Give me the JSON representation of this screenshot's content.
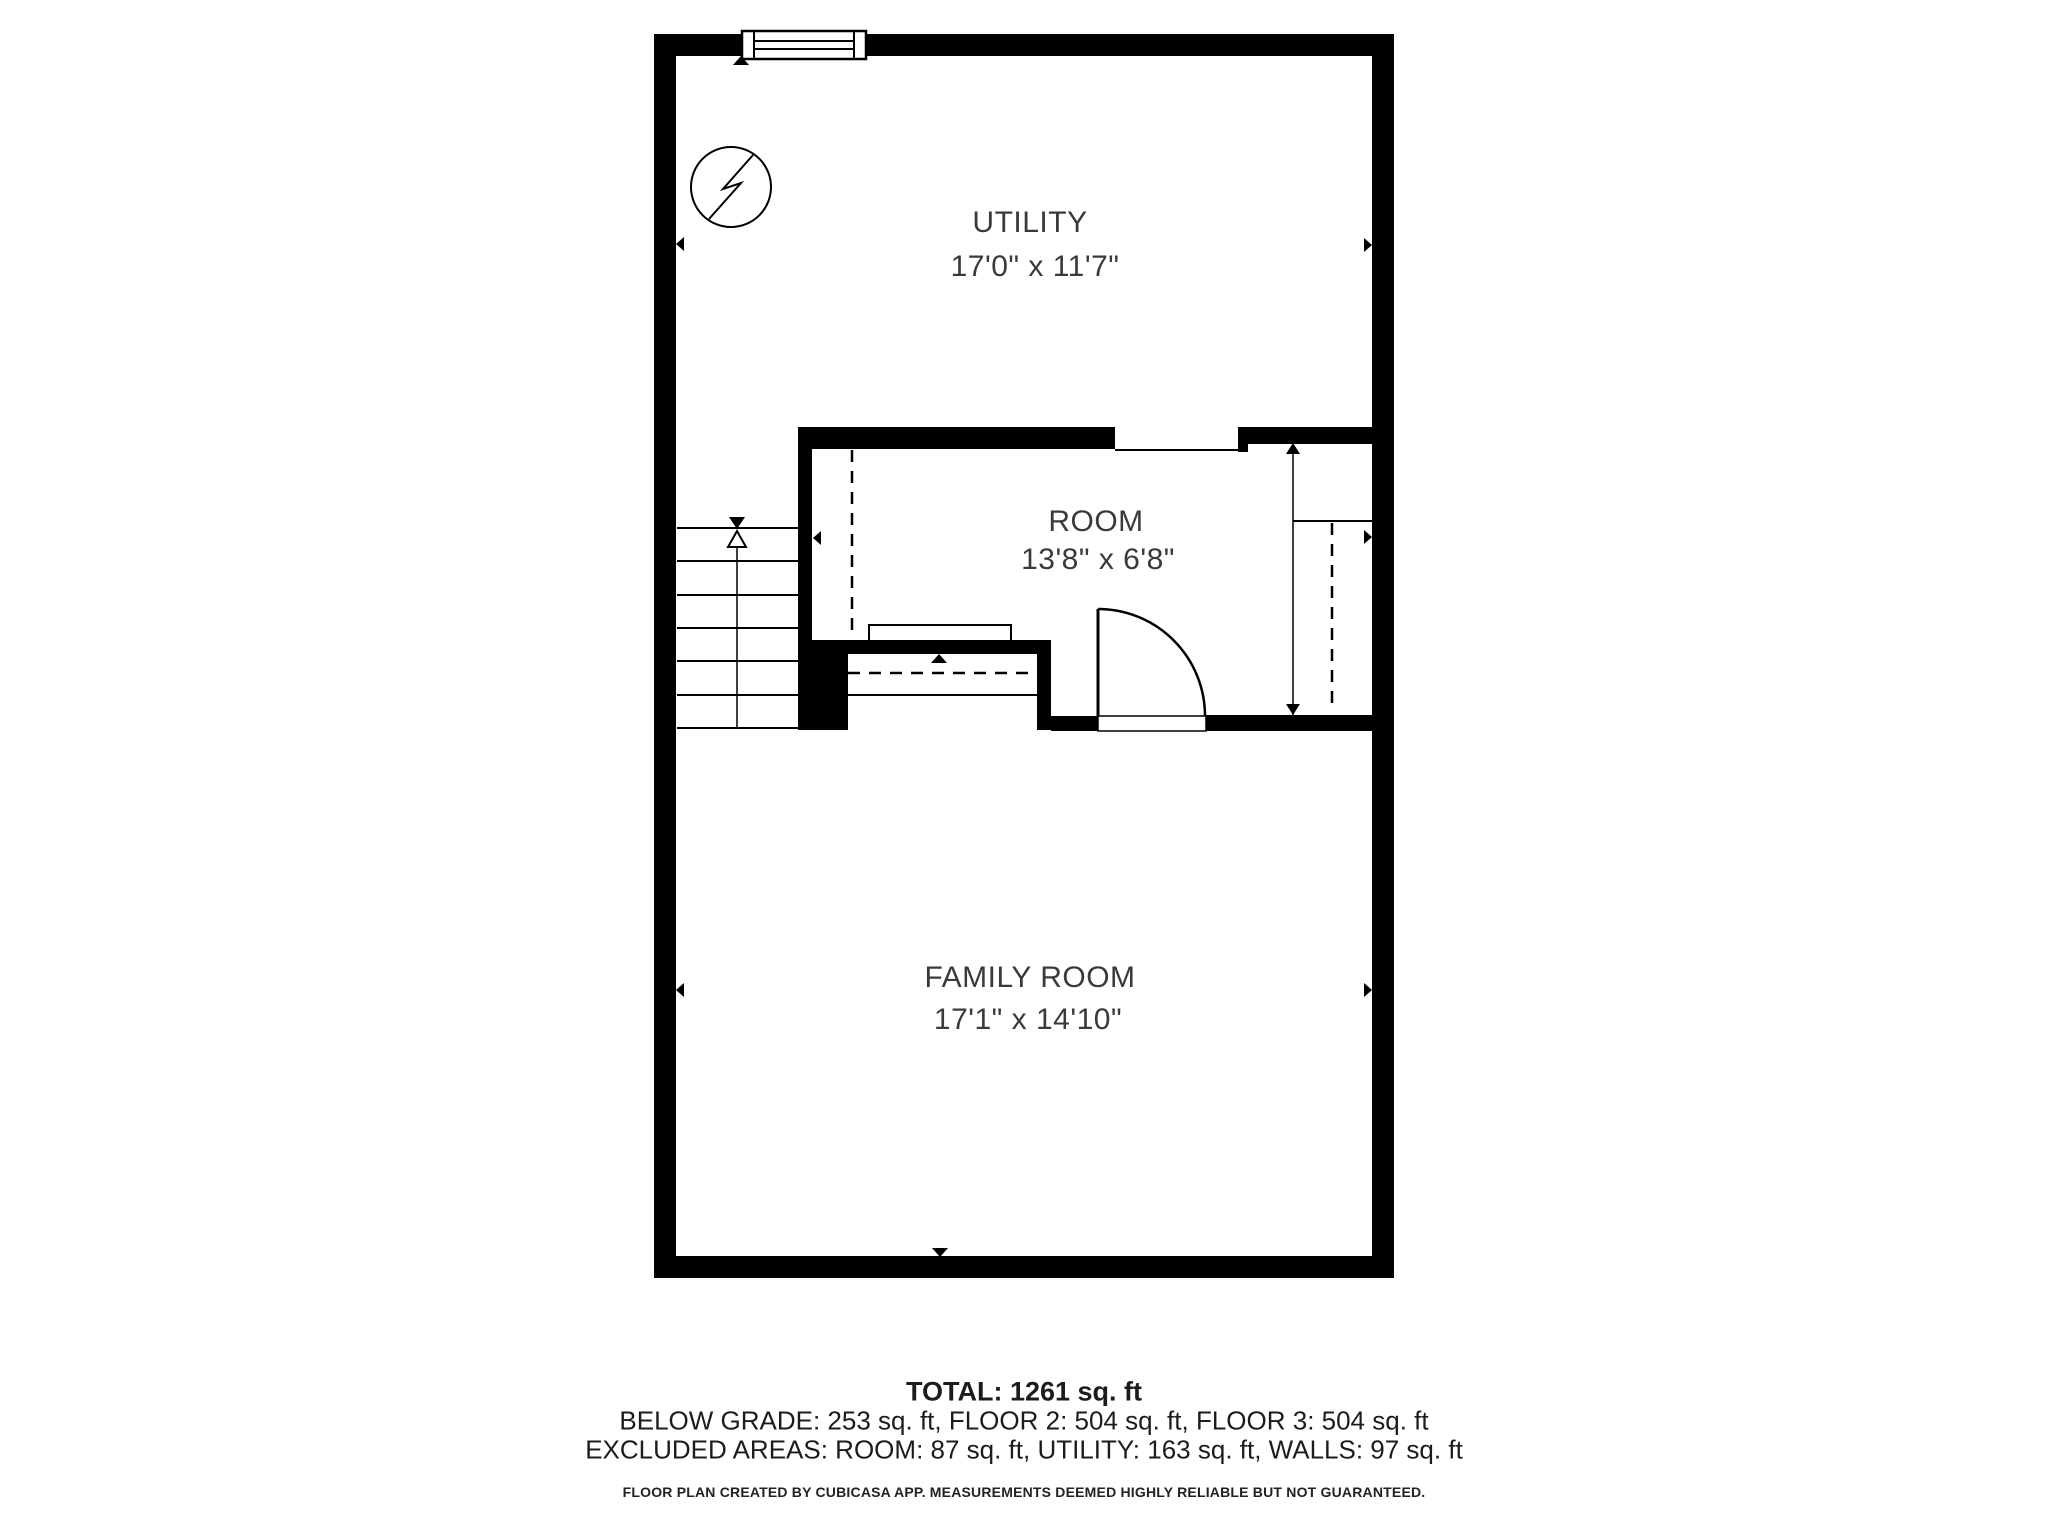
{
  "floor_plan": {
    "rooms": [
      {
        "name": "UTILITY",
        "dimensions": "17'0\" x 11'7\""
      },
      {
        "name": "ROOM",
        "dimensions": "13'8\" x 6'8\""
      },
      {
        "name": "FAMILY ROOM",
        "dimensions": "17'1\" x 14'10\""
      }
    ],
    "summary": {
      "total": "TOTAL: 1261 sq. ft",
      "breakdown": "BELOW GRADE: 253 sq. ft, FLOOR 2: 504 sq. ft, FLOOR 3: 504 sq. ft",
      "excluded": "EXCLUDED AREAS: ROOM: 87 sq. ft, UTILITY: 163 sq. ft, WALLS: 97 sq. ft",
      "disclaimer": "FLOOR PLAN CREATED BY CUBICASA APP. MEASUREMENTS DEEMED HIGHLY RELIABLE BUT NOT GUARANTEED."
    },
    "colors": {
      "wall": "#000000",
      "label_text": "#3a3a3a",
      "footer_text": "#1c1c1c",
      "background": "#ffffff"
    }
  }
}
